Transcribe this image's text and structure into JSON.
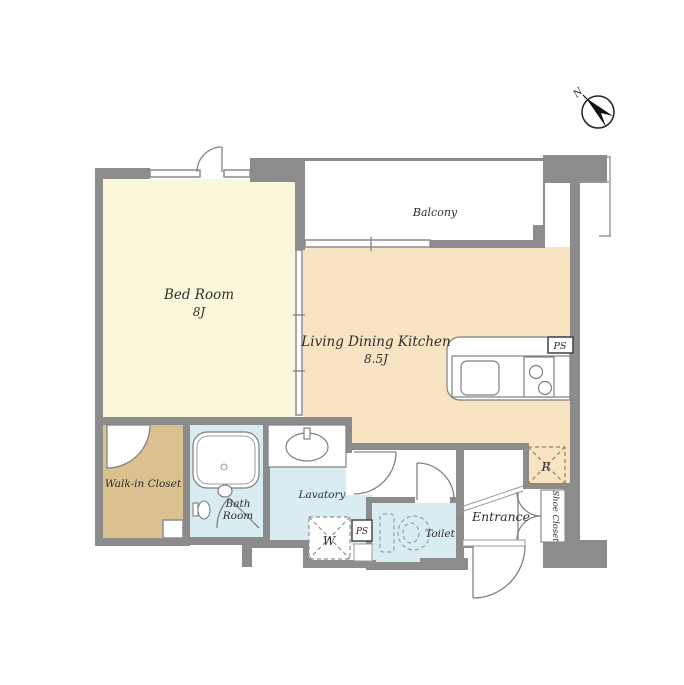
{
  "plan": {
    "title_hint": "apartment-floor-plan",
    "rooms": {
      "bedroom": {
        "name": "Bed Room",
        "size": "8J"
      },
      "ldk": {
        "name": "Living Dining Kitchen",
        "size": "8.5J"
      },
      "balcony": {
        "name": "Balcony"
      },
      "walk_in_closet": {
        "name": "Walk-in Closet"
      },
      "bath": {
        "line1": "Bath",
        "line2": "Room"
      },
      "lavatory": {
        "name": "Lavatory"
      },
      "toilet": {
        "name": "Toilet"
      },
      "entrance": {
        "name": "Entrance"
      },
      "shoe_closet": {
        "name": "Shoe Closet"
      }
    },
    "fixtures": {
      "washer": "W",
      "refrigerator": "R",
      "pipe_space_kitchen": "PS",
      "pipe_space_utility": "PS"
    },
    "compass": {
      "north": "N"
    },
    "colors": {
      "wall": "#8c8c8c",
      "bedroom_floor": "#faf7da",
      "ldk_floor": "#f8e3c2",
      "closet_floor": "#dcc190",
      "wet_floor": "#d9ecf2",
      "white": "#ffffff"
    }
  }
}
